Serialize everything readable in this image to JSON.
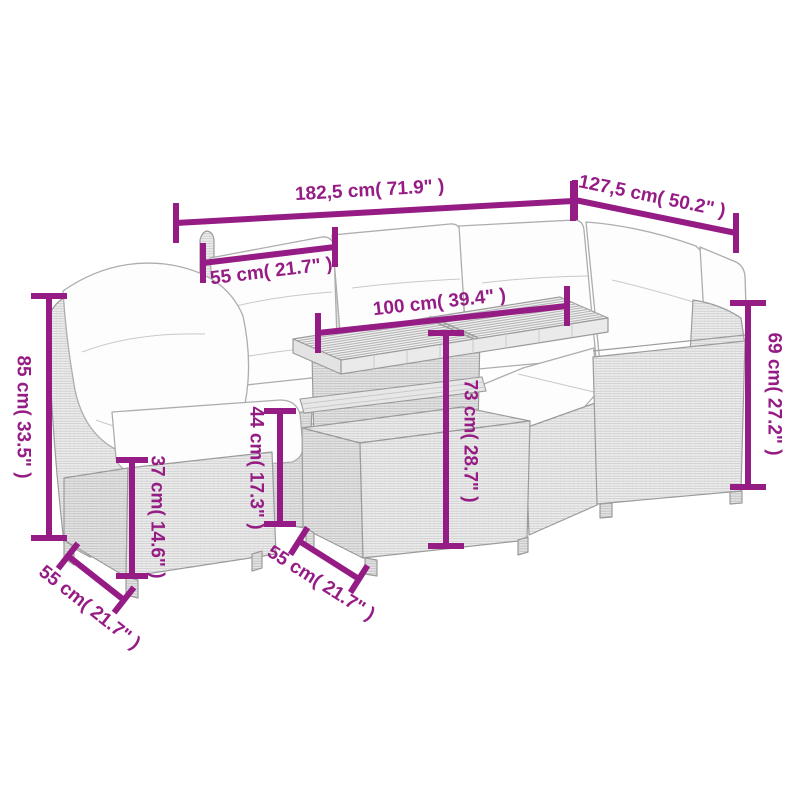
{
  "colors": {
    "dimension": "#961c85",
    "background": "#ffffff"
  },
  "dimensions": [
    {
      "id": "overall-width",
      "label": "182,5 cm( 71.9\" )"
    },
    {
      "id": "right-section-width",
      "label": "127,5 cm( 50.2\" )"
    },
    {
      "id": "seat-width",
      "label": "55 cm( 21.7\" )"
    },
    {
      "id": "table-length",
      "label": "100 cm( 39.4\" )"
    },
    {
      "id": "backrest-height",
      "label": "85 cm( 33.5\" )"
    },
    {
      "id": "seat-base-height",
      "label": "37 cm( 14.6\" )"
    },
    {
      "id": "seat-height",
      "label": "44 cm( 17.3\" )"
    },
    {
      "id": "table-height",
      "label": "73 cm( 28.7\" )"
    },
    {
      "id": "armrest-height",
      "label": "69 cm( 27.2\" )"
    },
    {
      "id": "stool-depth",
      "label": "55 cm( 21.7\" )"
    },
    {
      "id": "chair-depth",
      "label": "55 cm( 21.7\" )"
    }
  ]
}
